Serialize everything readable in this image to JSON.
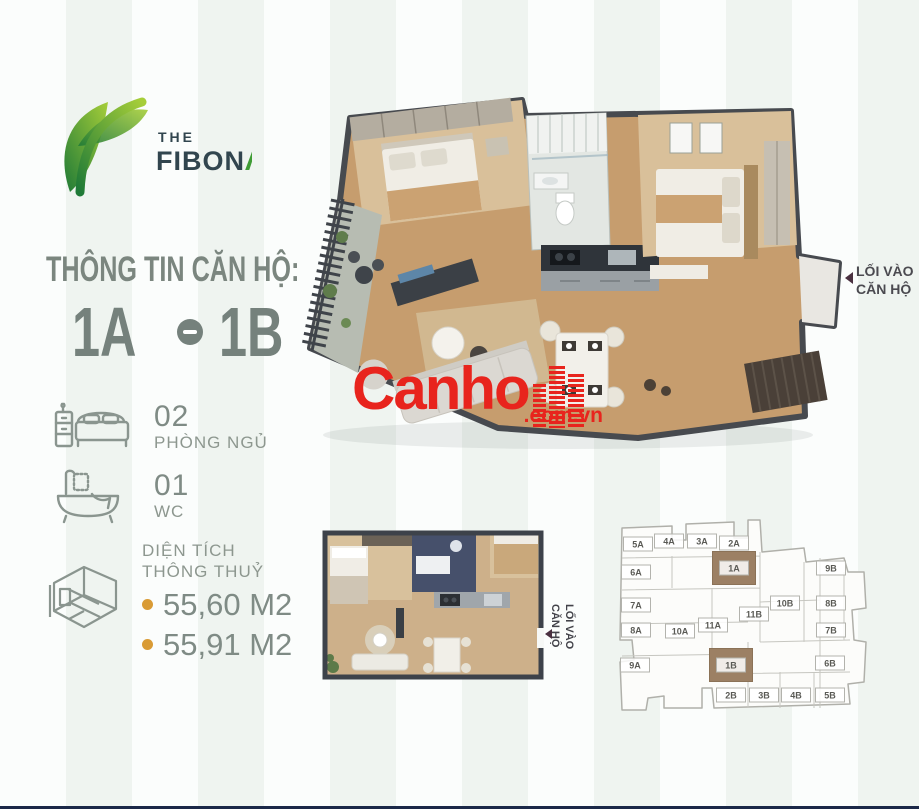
{
  "page": {
    "footer_line_color": "#1b2848"
  },
  "brand": {
    "the": "THE",
    "name_pre": "FIBON",
    "name_lambda": "Λ",
    "name_post": "N",
    "green_light": "#a6ce39",
    "green_dark": "#1f7a37"
  },
  "info": {
    "heading": "THÔNG TIN CĂN HỘ:",
    "unit_left": "1A",
    "unit_right": "1B"
  },
  "specs": {
    "bedrooms": {
      "count": "02",
      "label": "PHÒNG NGỦ"
    },
    "wc": {
      "count": "01",
      "label": "WC"
    },
    "area": {
      "label_line1": "DIỆN TÍCH",
      "label_line2": "THÔNG THUỶ",
      "values": [
        "55,60 M2",
        "55,91 M2"
      ],
      "bullet_color": "#d99b35"
    }
  },
  "entrance": {
    "line1": "LỐI VÀO",
    "line2": "CĂN HỘ"
  },
  "watermark": {
    "name": "Canho",
    "suffix": ".com.vn",
    "color": "#e8241d"
  },
  "key_plan": {
    "highlight_color": "#9c8064",
    "units": [
      {
        "id": "5A",
        "x": 30,
        "y": 32
      },
      {
        "id": "4A",
        "x": 61,
        "y": 29
      },
      {
        "id": "3A",
        "x": 94,
        "y": 29
      },
      {
        "id": "2A",
        "x": 126,
        "y": 31
      },
      {
        "id": "6A",
        "x": 28,
        "y": 60
      },
      {
        "id": "1A",
        "x": 126,
        "y": 56,
        "highlight": true
      },
      {
        "id": "9B",
        "x": 223,
        "y": 56
      },
      {
        "id": "7A",
        "x": 28,
        "y": 93
      },
      {
        "id": "10B",
        "x": 177,
        "y": 91
      },
      {
        "id": "8B",
        "x": 223,
        "y": 91
      },
      {
        "id": "11B",
        "x": 146,
        "y": 102
      },
      {
        "id": "8A",
        "x": 28,
        "y": 118
      },
      {
        "id": "10A",
        "x": 72,
        "y": 119
      },
      {
        "id": "11A",
        "x": 105,
        "y": 113
      },
      {
        "id": "7B",
        "x": 223,
        "y": 118
      },
      {
        "id": "9A",
        "x": 27,
        "y": 153
      },
      {
        "id": "1B",
        "x": 123,
        "y": 153,
        "highlight": true
      },
      {
        "id": "6B",
        "x": 222,
        "y": 151
      },
      {
        "id": "2B",
        "x": 123,
        "y": 183
      },
      {
        "id": "3B",
        "x": 156,
        "y": 183
      },
      {
        "id": "4B",
        "x": 188,
        "y": 183
      },
      {
        "id": "5B",
        "x": 222,
        "y": 183
      }
    ]
  }
}
